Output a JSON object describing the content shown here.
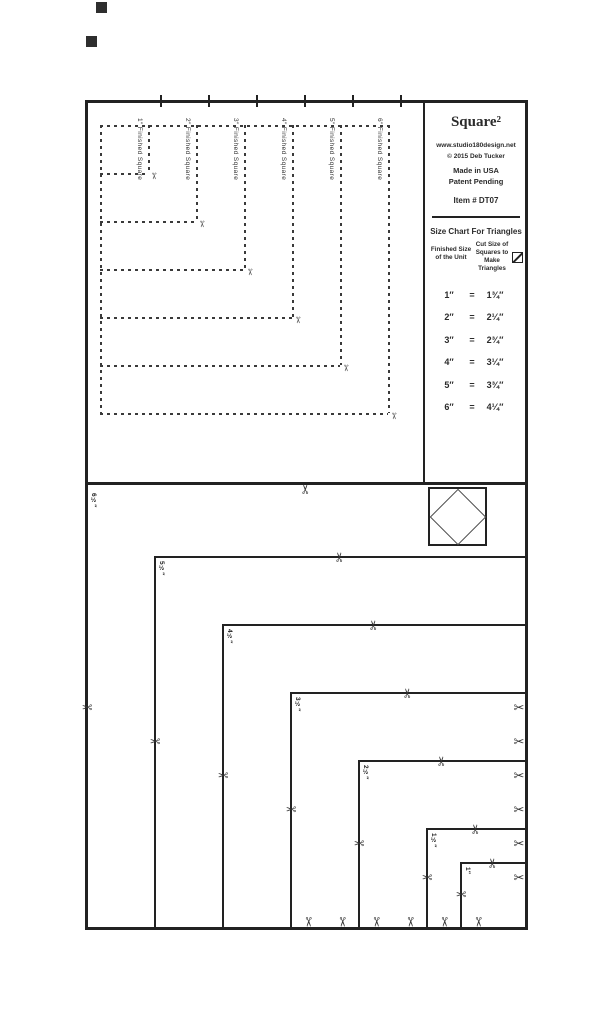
{
  "panel": {
    "title": "Square²",
    "website": "www.studio180design.net",
    "copyright": "© 2015 Deb Tucker",
    "made_in": "Made in USA",
    "patent": "Patent Pending",
    "item_number": "Item # DT07",
    "chart": {
      "title": "Size Chart For Triangles",
      "col1_header": "Finished Size of the Unit",
      "col2_header": "Cut Size of Squares to Make Triangles",
      "rows": [
        {
          "finished": "1″",
          "eq": "=",
          "cut": "1¾″"
        },
        {
          "finished": "2″",
          "eq": "=",
          "cut": "2¼″"
        },
        {
          "finished": "3″",
          "eq": "=",
          "cut": "2¾″"
        },
        {
          "finished": "4″",
          "eq": "=",
          "cut": "3¼″"
        },
        {
          "finished": "5″",
          "eq": "=",
          "cut": "3¾″"
        },
        {
          "finished": "6″",
          "eq": "=",
          "cut": "4¼″"
        }
      ]
    }
  },
  "top_section": {
    "squares": [
      {
        "label": "1″ Finished Square",
        "size_in": 1
      },
      {
        "label": "2″ Finished Square",
        "size_in": 2
      },
      {
        "label": "3″ Finished Square",
        "size_in": 3
      },
      {
        "label": "4″ Finished Square",
        "size_in": 4
      },
      {
        "label": "5″ Finished Square",
        "size_in": 5
      },
      {
        "label": "6″ Finished Square",
        "size_in": 6
      }
    ]
  },
  "bottom_section": {
    "squares": [
      {
        "label": "6½″",
        "size_in": 6.5
      },
      {
        "label": "5½″",
        "size_in": 5.5
      },
      {
        "label": "4½″",
        "size_in": 4.5
      },
      {
        "label": "3½″",
        "size_in": 3.5
      },
      {
        "label": "2½″",
        "size_in": 2.5
      },
      {
        "label": "1½″",
        "size_in": 1.5
      },
      {
        "label": "1″",
        "size_in": 1
      }
    ]
  },
  "icons": {
    "scissors": "✂",
    "hst_icon_name": "half-square-triangle-icon",
    "logo_name": "square-in-a-square-logo"
  }
}
